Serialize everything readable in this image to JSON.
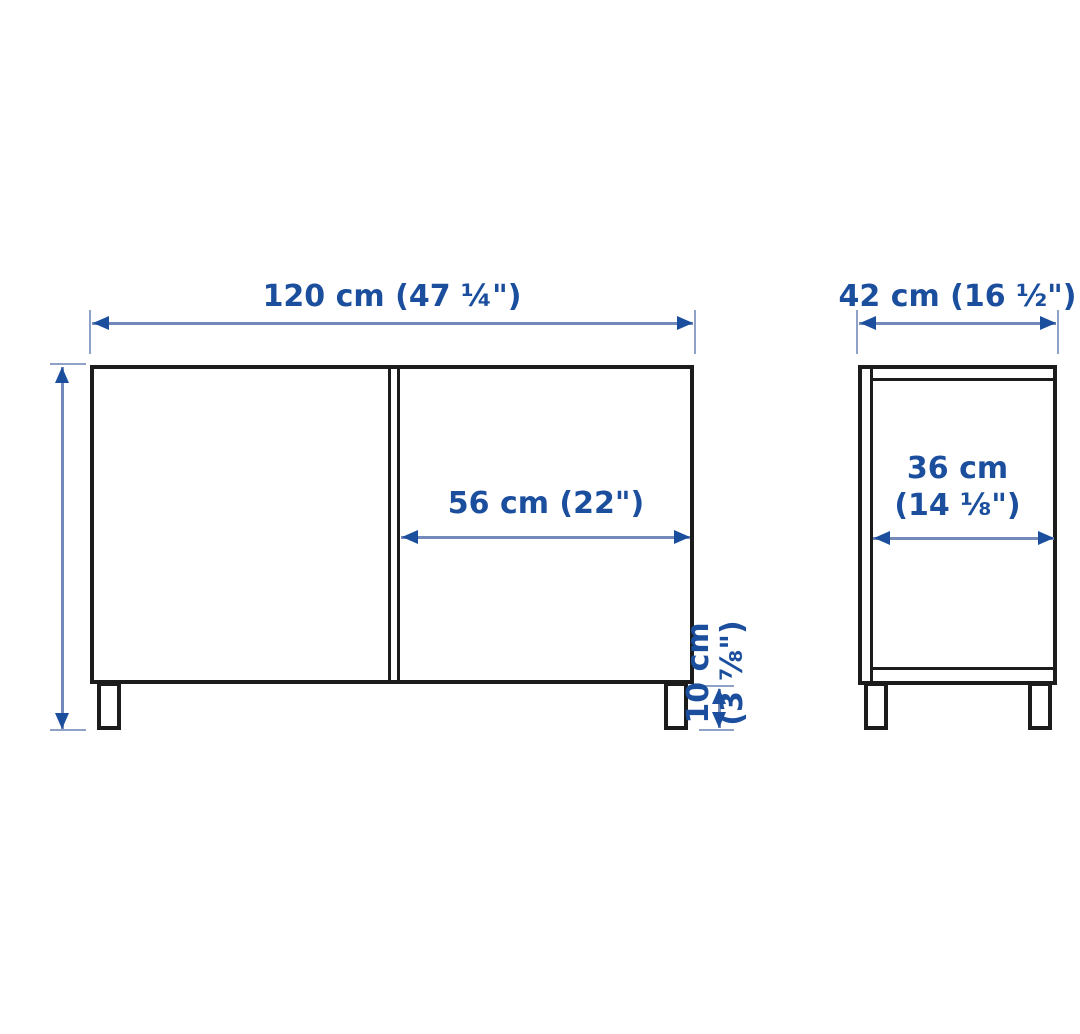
{
  "diagram": {
    "title": "cabinet-dimension-diagram",
    "colors": {
      "ink": "#1c1c1c",
      "blue": "#1b4f9e",
      "dimline": "#7389ba",
      "tick": "#8da2c6"
    },
    "front_view": {
      "width_label": "120 cm (47 ¼\")",
      "height_label": "74 cm (29 ⅛\")",
      "door_width_label": "56 cm (22\")",
      "leg_height_label_line1": "10 cm",
      "leg_height_label_line2": "(3 ⅞\")"
    },
    "side_view": {
      "depth_label": "42 cm (16 ½\")",
      "inner_depth_label_line1": "36 cm",
      "inner_depth_label_line2": "(14 ⅛\")"
    }
  }
}
